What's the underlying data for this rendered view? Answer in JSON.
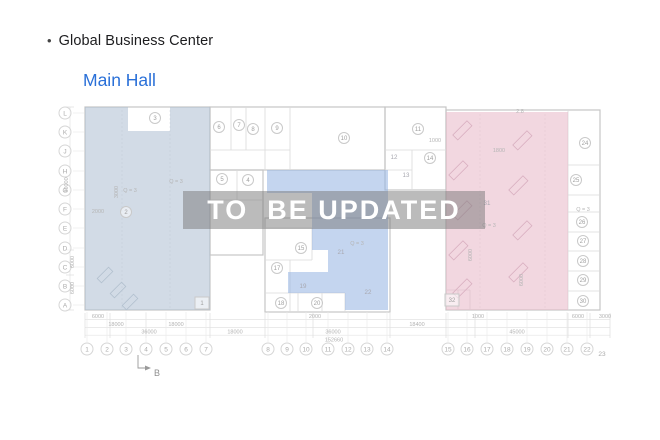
{
  "header": {
    "bullet": "•",
    "title": "Global Business Center",
    "hall_label": "Main Hall"
  },
  "colors": {
    "accent_blue": "#2a70d8",
    "title_text": "#1d1d1f",
    "region_left_fill": "rgba(173,190,209,0.55)",
    "region_left_border": "#b6c3d3",
    "region_center_fill": "rgba(147,178,226,0.55)",
    "region_center_border": "#a9c0e4",
    "region_right_fill": "rgba(231,183,198,0.55)",
    "region_right_border": "#ddb4c4",
    "equipment_left": "#b2c0cf",
    "equipment_right": "#d9afc0",
    "watermark_band": "rgba(120,120,120,0.5)",
    "watermark_text": "#ffffff"
  },
  "watermark": {
    "text": "TO  BE UPDATED"
  },
  "plan": {
    "row_labels": [
      {
        "label": "L",
        "y": 113
      },
      {
        "label": "K",
        "y": 132
      },
      {
        "label": "J",
        "y": 151
      },
      {
        "label": "H",
        "y": 171
      },
      {
        "label": "G",
        "y": 190
      },
      {
        "label": "F",
        "y": 209
      },
      {
        "label": "E",
        "y": 228
      },
      {
        "label": "D",
        "y": 248
      },
      {
        "label": "C",
        "y": 267
      },
      {
        "label": "B",
        "y": 286
      },
      {
        "label": "A",
        "y": 305
      }
    ],
    "col_labels": [
      {
        "label": "1",
        "x": 87
      },
      {
        "label": "2",
        "x": 107
      },
      {
        "label": "3",
        "x": 126
      },
      {
        "label": "4",
        "x": 146
      },
      {
        "label": "5",
        "x": 166
      },
      {
        "label": "6",
        "x": 186
      },
      {
        "label": "7",
        "x": 206
      },
      {
        "label": "8",
        "x": 268
      },
      {
        "label": "9",
        "x": 287
      },
      {
        "label": "10",
        "x": 306
      },
      {
        "label": "11",
        "x": 328
      },
      {
        "label": "12",
        "x": 348
      },
      {
        "label": "13",
        "x": 367
      },
      {
        "label": "14",
        "x": 387
      },
      {
        "label": "15",
        "x": 448
      },
      {
        "label": "16",
        "x": 467
      },
      {
        "label": "17",
        "x": 487
      },
      {
        "label": "18",
        "x": 507
      },
      {
        "label": "19",
        "x": 527
      },
      {
        "label": "20",
        "x": 547
      },
      {
        "label": "21",
        "x": 567
      },
      {
        "label": "22",
        "x": 587
      },
      {
        "label": "23",
        "x": 602,
        "plain": true
      }
    ],
    "rooms_circled": [
      {
        "label": "3",
        "x": 155,
        "y": 118
      },
      {
        "label": "6",
        "x": 219,
        "y": 127
      },
      {
        "label": "7",
        "x": 239,
        "y": 125
      },
      {
        "label": "8",
        "x": 253,
        "y": 129
      },
      {
        "label": "9",
        "x": 277,
        "y": 128
      },
      {
        "label": "10",
        "x": 344,
        "y": 138
      },
      {
        "label": "11",
        "x": 418,
        "y": 129
      },
      {
        "label": "14",
        "x": 430,
        "y": 158
      },
      {
        "label": "5",
        "x": 222,
        "y": 179
      },
      {
        "label": "4",
        "x": 248,
        "y": 180
      },
      {
        "label": "2",
        "x": 126,
        "y": 212
      },
      {
        "label": "15",
        "x": 301,
        "y": 248
      },
      {
        "label": "17",
        "x": 277,
        "y": 268
      },
      {
        "label": "18",
        "x": 281,
        "y": 303
      },
      {
        "label": "20",
        "x": 317,
        "y": 303
      },
      {
        "label": "24",
        "x": 585,
        "y": 143
      },
      {
        "label": "25",
        "x": 576,
        "y": 180
      },
      {
        "label": "26",
        "x": 582,
        "y": 222
      },
      {
        "label": "27",
        "x": 583,
        "y": 241
      },
      {
        "label": "28",
        "x": 583,
        "y": 261
      },
      {
        "label": "29",
        "x": 583,
        "y": 280
      },
      {
        "label": "30",
        "x": 583,
        "y": 301
      }
    ],
    "rooms_plain": [
      {
        "label": "12",
        "x": 394,
        "y": 157
      },
      {
        "label": "13",
        "x": 406,
        "y": 175
      },
      {
        "label": "19",
        "x": 303,
        "y": 286
      },
      {
        "label": "21",
        "x": 341,
        "y": 252
      },
      {
        "label": "22",
        "x": 368,
        "y": 292
      },
      {
        "label": "31",
        "x": 487,
        "y": 203
      }
    ],
    "rooms_boxed": [
      {
        "label": "1",
        "x": 202,
        "y": 303
      },
      {
        "label": "32",
        "x": 452,
        "y": 300
      }
    ],
    "annotations": [
      {
        "text": "Q = 3",
        "x": 130,
        "y": 192
      },
      {
        "text": "Q = 3",
        "x": 176,
        "y": 183
      },
      {
        "text": "Q = 3",
        "x": 357,
        "y": 245
      },
      {
        "text": "Q = 3",
        "x": 489,
        "y": 227
      },
      {
        "text": "Q = 3",
        "x": 583,
        "y": 211
      },
      {
        "text": "2000",
        "x": 98,
        "y": 213
      },
      {
        "text": "1800",
        "x": 499,
        "y": 152
      },
      {
        "text": "1000",
        "x": 435,
        "y": 142
      },
      {
        "text": "2.8",
        "x": 520,
        "y": 113
      }
    ],
    "annotations_vertical": [
      {
        "text": "60000",
        "x": 68,
        "y": 185
      },
      {
        "text": "6000",
        "x": 74,
        "y": 262
      },
      {
        "text": "6000",
        "x": 74,
        "y": 288
      },
      {
        "text": "6000",
        "x": 472,
        "y": 255
      },
      {
        "text": "6000",
        "x": 523,
        "y": 280
      },
      {
        "text": "3000",
        "x": 118,
        "y": 192
      }
    ],
    "dimensions": [
      {
        "text": "6000",
        "x": 98,
        "y": 318
      },
      {
        "text": "2000",
        "x": 315,
        "y": 318
      },
      {
        "text": "1000",
        "x": 478,
        "y": 318
      },
      {
        "text": "6000",
        "x": 578,
        "y": 318
      },
      {
        "text": "3000",
        "x": 605,
        "y": 318
      },
      {
        "text": "18000",
        "x": 116,
        "y": 326
      },
      {
        "text": "18000",
        "x": 176,
        "y": 326
      },
      {
        "text": "18400",
        "x": 417,
        "y": 326
      },
      {
        "text": "36000",
        "x": 149,
        "y": 333.5
      },
      {
        "text": "18000",
        "x": 235,
        "y": 333.5
      },
      {
        "text": "36000",
        "x": 333,
        "y": 333.5
      },
      {
        "text": "45000",
        "x": 517,
        "y": 333.5
      },
      {
        "text": "152660",
        "x": 334,
        "y": 341.5
      }
    ],
    "section_marker": {
      "label": "B"
    }
  }
}
